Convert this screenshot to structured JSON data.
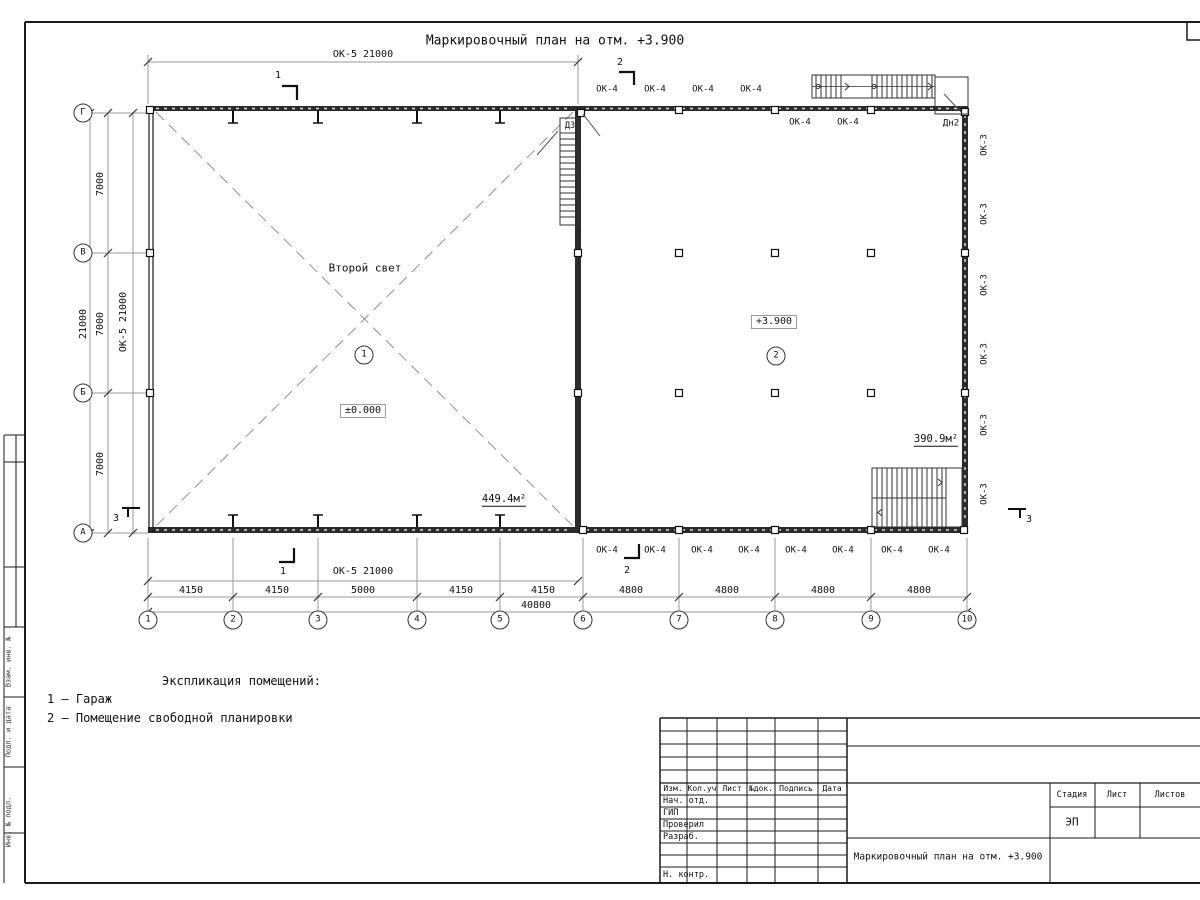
{
  "drawing": {
    "title": "Маркировочный план на отм. +3.900"
  },
  "grid": {
    "cols": [
      "1",
      "2",
      "3",
      "4",
      "5",
      "6",
      "7",
      "8",
      "9",
      "10"
    ],
    "rows": [
      "Г",
      "В",
      "Б",
      "А"
    ]
  },
  "dimensions": {
    "top_window": "ОК-5 21000",
    "bottom_window": "ОК-5 21000",
    "left_window": "ОК-5 21000",
    "left_spans": [
      "7000",
      "7000",
      "7000"
    ],
    "left_total": "21000",
    "bottom_segments": [
      "4150",
      "4150",
      "5000",
      "4150",
      "4150",
      "4800",
      "4800",
      "4800",
      "4800"
    ],
    "bottom_total": "40800"
  },
  "sections": {
    "s1": "1",
    "s2": "2",
    "s3": "3"
  },
  "rooms": {
    "room1": {
      "number": "1",
      "note": "Второй свет",
      "level": "±0.000",
      "area": "449.4м²"
    },
    "room2": {
      "number": "2",
      "level": "+3.900",
      "area": "390.9м²"
    }
  },
  "marks": {
    "d3": "Д3",
    "dn2": "Дн2",
    "ok3": [
      "ОК-3",
      "ОК-3",
      "ОК-3",
      "ОК-3",
      "ОК-3",
      "ОК-3"
    ],
    "ok4_top": [
      "ОК-4",
      "ОК-4",
      "ОК-4",
      "ОК-4"
    ],
    "ok4_top_inner": [
      "ОК-4",
      "ОК-4"
    ],
    "ok4_bottom": [
      "ОК-4",
      "ОК-4",
      "ОК-4",
      "ОК-4",
      "ОК-4",
      "ОК-4",
      "ОК-4",
      "ОК-4"
    ]
  },
  "legend": {
    "heading": "Экспликация помещений:",
    "items": [
      "1 – Гараж",
      "2 – Помещение свободной планировки"
    ]
  },
  "titleblock": {
    "columns": [
      "Изм.",
      "Кол.уч",
      "Лист",
      "№док.",
      "Подпись",
      "Дата"
    ],
    "rows": [
      "Нач. отд.",
      "ГИП",
      "Проверил",
      "Разраб.",
      "Н. контр."
    ],
    "stage_label": "Стадия",
    "sheet_label": "Лист",
    "sheets_label": "Листов",
    "stage_value": "ЭП",
    "doc_title": "Маркировочный план на отм. +3.900"
  },
  "frame": {
    "side_labels": [
      "Взам. инв. №",
      "Подп. и дата",
      "Инв. № подл."
    ]
  }
}
